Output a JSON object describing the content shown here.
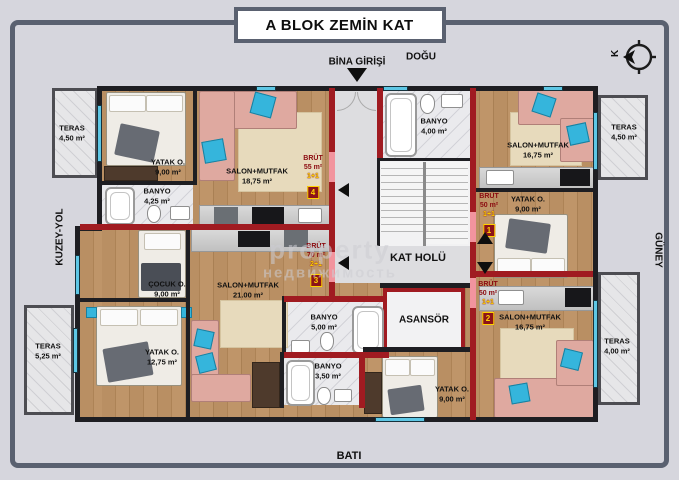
{
  "title": "A BLOK ZEMİN KAT",
  "compass": {
    "north_letter": "K"
  },
  "directions": {
    "top": "DOĞU",
    "left": "KUZEY-YOL",
    "right": "GÜNEY",
    "bottom": "BATI"
  },
  "entrance_label": "BİNA GİRİŞİ",
  "core": {
    "hall_label": "KAT HOLÜ",
    "elevator_label": "ASANSÖR",
    "bathroom": {
      "name": "BANYO",
      "area": "4,00 m²"
    }
  },
  "apartments": {
    "unit1": {
      "brut_title": "BRÜT",
      "brut_area": "50 m²",
      "layout": "1+1",
      "number": "1",
      "salon": {
        "name": "SALON+MUTFAK",
        "area": "16,75 m²"
      },
      "bedroom": {
        "name": "YATAK O.",
        "area": "9,00 m²"
      },
      "terrace": {
        "name": "TERAS",
        "area": "4,50 m²"
      }
    },
    "unit2": {
      "brut_title": "BRÜT",
      "brut_area": "50 m²",
      "layout": "1+1",
      "number": "2",
      "salon": {
        "name": "SALON+MUTFAK",
        "area": "16,75 m²"
      },
      "bedroom": {
        "name": "YATAK O.",
        "area": "9,00 m²"
      },
      "bathroom": {
        "name": "BANYO",
        "area": "3,50 m²"
      },
      "terrace": {
        "name": "TERAS",
        "area": "4,00 m²"
      }
    },
    "unit3": {
      "brut_title": "BRÜT",
      "brut_area": "70 m²",
      "layout": "2+1",
      "number": "3",
      "salon": {
        "name": "SALON+MUTFAK",
        "area": "21.00 m²"
      },
      "bedroom": {
        "name": "YATAK O.",
        "area": "12,75 m²"
      },
      "kids_room": {
        "name": "ÇOCUK O.",
        "area": "9,00 m²"
      },
      "bathroom": {
        "name": "BANYO",
        "area": "5,00 m²"
      },
      "terrace": {
        "name": "TERAS",
        "area": "5,25 m²"
      }
    },
    "unit4": {
      "brut_title": "BRÜT",
      "brut_area": "55 m²",
      "layout": "1+1",
      "number": "4",
      "salon": {
        "name": "SALON+MUTFAK",
        "area": "18,75 m²"
      },
      "bedroom": {
        "name": "YATAK O.",
        "area": "9,00 m²"
      },
      "bathroom": {
        "name": "BANYO",
        "area": "4,25 m²"
      },
      "terrace": {
        "name": "TERAS",
        "area": "4,50 m²"
      }
    }
  },
  "watermark": {
    "line1": "property",
    "line2": "недвижимость"
  }
}
